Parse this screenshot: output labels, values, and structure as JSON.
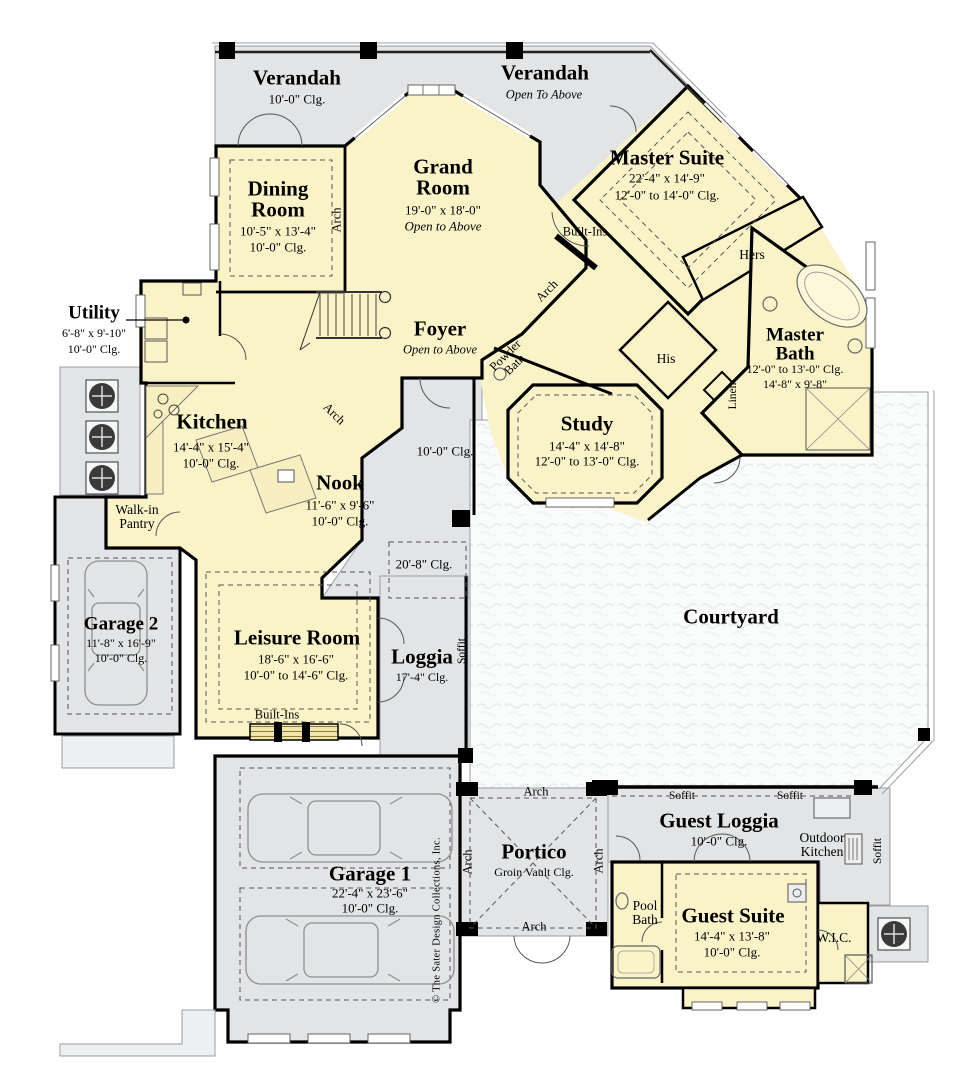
{
  "plan": {
    "copyright": "© The Sater Design Collections, Inc.",
    "colors": {
      "interior": "#FBF3C8",
      "outdoor": "#E2E4E6",
      "courtyard": "#FAFBFB",
      "wall": "#000000"
    },
    "rooms": {
      "verandah_left": {
        "name": "Verandah",
        "clg": "10'-0\"  Clg."
      },
      "verandah_right": {
        "name": "Verandah",
        "note": "Open To Above"
      },
      "dining": {
        "name": "Dining Room",
        "dim": "10'-5\" x 13'-4\"",
        "clg": "10'-0\"  Clg."
      },
      "grand": {
        "name": "Grand Room",
        "dim": "19'-0\" x 18'-0\"",
        "note": "Open to Above"
      },
      "master_suite": {
        "name": "Master Suite",
        "dim": "22'-4\" x 14'-9\"",
        "clg": "12'-0\" to 14'-0\" Clg."
      },
      "utility": {
        "name": "Utility",
        "dim": "6'-8\" x 9'-10\"",
        "clg": "10'-0\"  Clg."
      },
      "foyer": {
        "name": "Foyer",
        "note": "Open to Above"
      },
      "kitchen": {
        "name": "Kitchen",
        "dim": "14'-4\" x 15'-4\"",
        "clg": "10'-0\"  Clg."
      },
      "nook": {
        "name": "Nook",
        "dim": "11'-6\" x 9'-6\"",
        "clg": "10'-0\"  Clg."
      },
      "study": {
        "name": "Study",
        "dim": "14'-4\" x 14'-8\"",
        "clg": "12'-0\" to 13'-0\" Clg."
      },
      "master_bath": {
        "name": "Master Bath",
        "clg": "12'-0\" to 13'-0\" Clg.",
        "dim": "14'-8\" x 9'-8\""
      },
      "powder": {
        "name": "Powder Bath"
      },
      "pantry": {
        "name": "Walk-in Pantry"
      },
      "garage2": {
        "name": "Garage 2",
        "dim": "11'-8\" x 16'-9\"",
        "clg": "10'-0\" Clg."
      },
      "leisure": {
        "name": "Leisure Room",
        "dim": "18'-6\" x 16'-6\"",
        "clg": "10'-0\" to 14'-6\"  Clg."
      },
      "loggia": {
        "name": "Loggia",
        "clg": "17'-4\" Clg."
      },
      "courtyard": {
        "name": "Courtyard"
      },
      "garage1": {
        "name": "Garage 1",
        "dim": "22'-4\" x 23'-6\"",
        "clg": "10'-0\" Clg."
      },
      "portico": {
        "name": "Portico",
        "clg": "Groin Vault Clg."
      },
      "guest_loggia": {
        "name": "Guest Loggia",
        "clg": "10'-0\" Clg."
      },
      "outdoor_kitchen": {
        "name": "Outdoor Kitchen"
      },
      "pool_bath": {
        "name": "Pool Bath"
      },
      "guest_suite": {
        "name": "Guest Suite",
        "dim": "14'-4\" x 13'-8\"",
        "clg": "10'-0\" Clg."
      },
      "wic": {
        "name": "W.I.C."
      }
    },
    "annotations": {
      "arch": "Arch",
      "soffit": "Soffit",
      "built_ins": "Built-Ins",
      "hers": "Hers",
      "his": "His",
      "linen": "Linen",
      "gallery_clg": "10'-0\" Clg.",
      "high_clg": "20'-8\" Clg."
    }
  }
}
